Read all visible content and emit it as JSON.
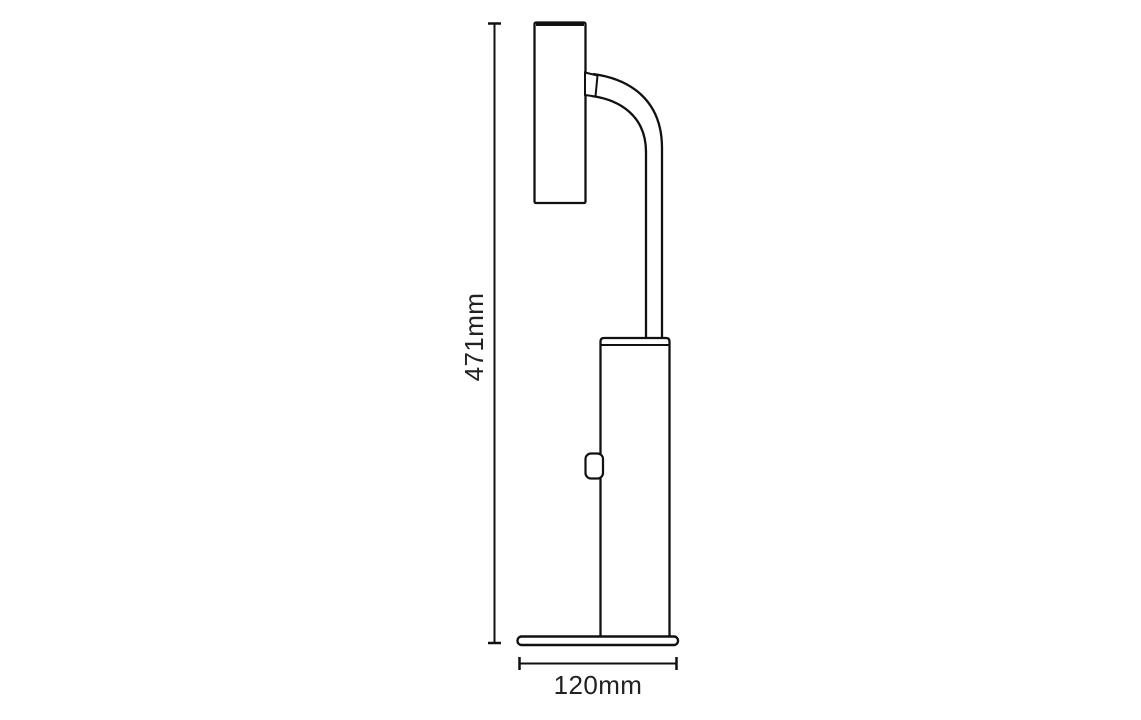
{
  "diagram": {
    "type": "technical-drawing",
    "labels": {
      "height": "471mm",
      "width": "120mm"
    },
    "colors": {
      "line": "#111111",
      "text": "#222222",
      "background": "#ffffff"
    }
  }
}
